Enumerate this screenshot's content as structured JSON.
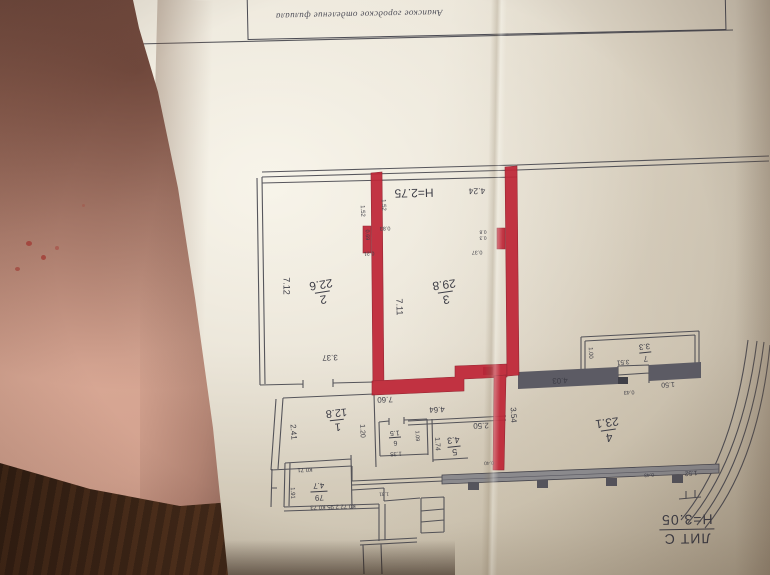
{
  "stamp": {
    "title": "Анапское городское отделение филиала"
  },
  "lit": {
    "label": "ЛИТ С",
    "height": "H=3.05"
  },
  "plan": {
    "ceiling_height": "H=2.75"
  },
  "colors": {
    "marker_red": "#bf2637",
    "ink": "#3e3e47",
    "paper": "#e9e3d6"
  },
  "rooms": [
    {
      "id": "room-1",
      "number": "1",
      "area": "12.8"
    },
    {
      "id": "room-2",
      "number": "2",
      "area": "22.6"
    },
    {
      "id": "room-3",
      "number": "3",
      "area": "29.8"
    },
    {
      "id": "room-4",
      "number": "4",
      "area": "23.1"
    },
    {
      "id": "room-5",
      "number": "5",
      "area": "4.3"
    },
    {
      "id": "room-6",
      "number": "6",
      "area": "1.5"
    },
    {
      "id": "room-7",
      "number": "7",
      "area": "3.3"
    },
    {
      "id": "room-79",
      "number": "79",
      "area": "4.7"
    }
  ],
  "dims": {
    "d4_24": "4.24",
    "d7_12": "7.12",
    "d7_11": "7.11",
    "d3_37": "3.37",
    "d1_52a": "1.52",
    "d1_52b": "1.52",
    "d1_52c": "1.52",
    "d0_83": "0.83",
    "d0_69": "0.69",
    "d0_21": "0.21",
    "d0_8": "0.8",
    "d0_3": "0.3",
    "d0_37": "0.37",
    "d7_60": "7.60",
    "d4_64": "4.64",
    "d2_41": "2.41",
    "d1_20": "1.20",
    "d1_35": "1.35",
    "d1_09": "1.09",
    "d1_74": "1.74",
    "d2_50": "2.50",
    "d3_54": "3.54",
    "d0_40": "0.40",
    "d4_03": "4.03",
    "d1_50": "1.50",
    "d0_43a": "0.43",
    "d0_43b": "0.43",
    "d3_51": "3.51",
    "d1_00": "1.00",
    "d1_31": "1.31",
    "dk0_71": "К0.71",
    "d1_91": "1.91",
    "dk_row": "К0.72  2.95  К0.73"
  }
}
